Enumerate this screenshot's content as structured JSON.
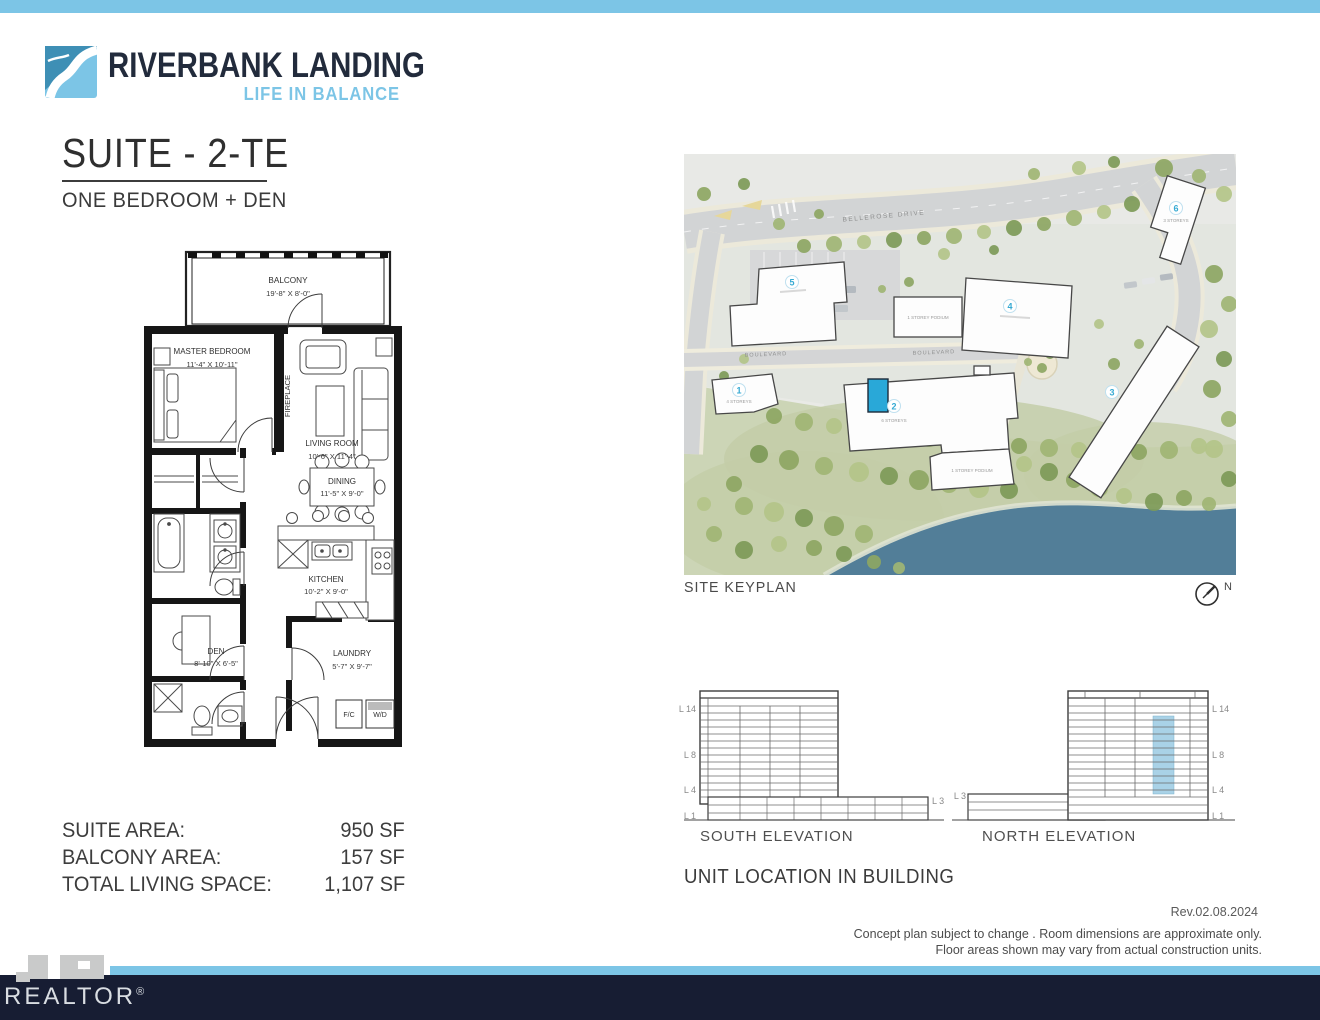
{
  "header": {
    "brand_name": "RIVERBANK LANDING",
    "brand_tagline": "LIFE IN BALANCE"
  },
  "suite": {
    "title": "SUITE - 2-TE",
    "subtitle": "ONE BEDROOM + DEN"
  },
  "floorplan": {
    "balcony_name": "BALCONY",
    "balcony_dims": "19'-8\" X 8'-0\"",
    "master_name": "MASTER BEDROOM",
    "master_dims": "11'-4\" X 10'-11\"",
    "fireplace": "FIREPLACE",
    "living_name": "LIVING ROOM",
    "living_dims": "10'-6\" X 11'-4\"",
    "dining_name": "DINING",
    "dining_dims": "11'-5\" X 9'-0\"",
    "kitchen_name": "KITCHEN",
    "kitchen_dims": "10'-2\" X 9'-0\"",
    "den_name": "DEN",
    "den_dims": "8'-10\" X 6'-5\"",
    "laundry_name": "LAUNDRY",
    "laundry_dims": "5'-7\" X 9'-7\"",
    "fc": "F/C",
    "wd": "W/D"
  },
  "areas": {
    "suite_label": "SUITE AREA:",
    "suite_value": "950 SF",
    "balcony_label": "BALCONY AREA:",
    "balcony_value": "157 SF",
    "total_label": "TOTAL LIVING SPACE:",
    "total_value": "1,107 SF"
  },
  "keyplan": {
    "caption": "SITE KEYPLAN",
    "north": "N",
    "street_bellerose": "BELLEROSE DRIVE",
    "street_boulevard": "BOULEVARD",
    "b1": "1",
    "b2": "2",
    "b3": "3",
    "b4": "4",
    "b5": "5",
    "b6": "6",
    "b1_label": "4 STOREYS",
    "b2_label": "6 STOREYS",
    "b6_label": "3 STOREYS",
    "podium_label": "1 STOREY PODIUM"
  },
  "elevations": {
    "south_label": "SOUTH ELEVATION",
    "north_label": "NORTH ELEVATION",
    "l14": "L 14",
    "l8": "L 8",
    "l4": "L 4",
    "l1": "L 1",
    "l3": "L 3"
  },
  "unit_location": {
    "title": "UNIT LOCATION IN BUILDING"
  },
  "footer": {
    "revision": "Rev.02.08.2024",
    "disclaimer1": "Concept plan subject to change . Room dimensions are approximate only.",
    "disclaimer2": "Floor areas shown may vary from actual construction units.",
    "watermark": "REALTOR",
    "registered": "®"
  },
  "colors": {
    "accent": "#7cc5e6",
    "navy": "#171d33",
    "unit_marker": "#29a8d8",
    "unit_strip": "#a9d2e7",
    "water": "#527e98"
  }
}
